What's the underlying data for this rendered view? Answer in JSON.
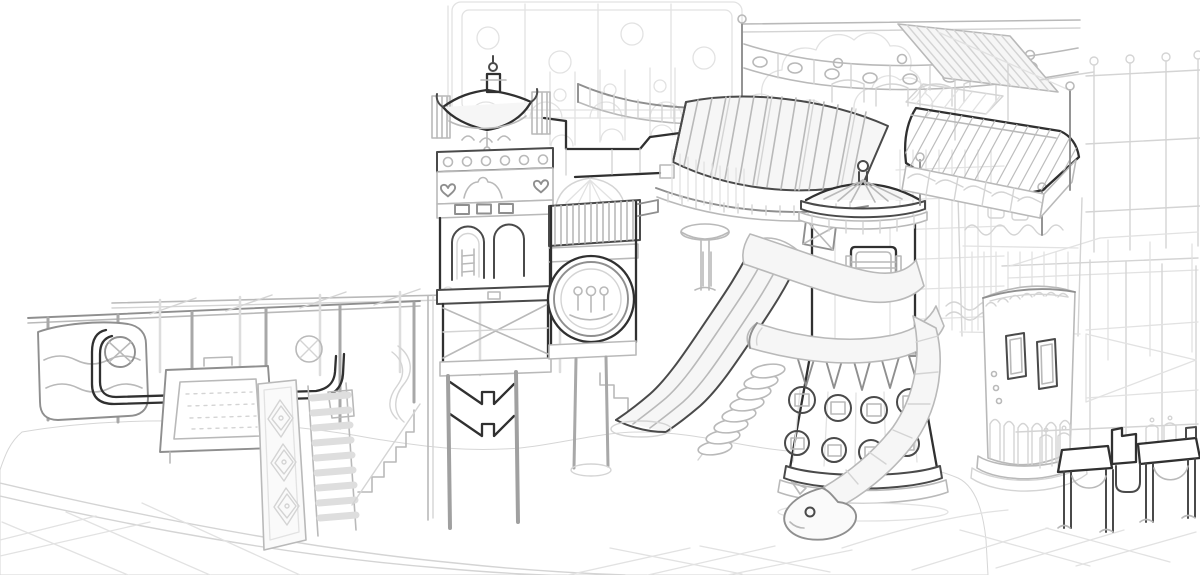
{
  "meta": {
    "title": "Indoor playground structure - concept line sketch",
    "medium": "grayscale pencil-style digital sketch",
    "canvas_width": 1200,
    "canvas_height": 575
  },
  "palette": {
    "background": "#ffffff",
    "line_faint": "#e2e2e2",
    "line_mid": "#b9b9b9",
    "line_dark": "#8f8f8f",
    "line_emphasis": "#303030",
    "shade_light": "#f6f6f6",
    "ball_line": "#c9c9c9"
  },
  "scene": {
    "description": "Hand-drawn isometric concept sketch of an indoor children's playground: towers with pagoda and dome roofs, wave and tube slides, climbing frames, striped awnings and a large ball pit on a tiled floor.",
    "elements": {
      "wall_panels": {
        "label": "Faint background wall panels with circles and arches"
      },
      "foliage": {
        "label": "Soft foliage cloud outlines"
      },
      "rail_bridge": {
        "label": "Elevated bridge railing with oval cutouts and striped roof"
      },
      "top_right_frame": {
        "label": "Tall open frame with ball finials"
      },
      "scaffold_frame": {
        "label": "Open scaffold frame with triangular platform"
      },
      "background_tower": {
        "label": "Background tower with scalloped band"
      },
      "walkway_bridge": {
        "label": "Curved raised walkway with stepped parapet"
      },
      "ball_pit": {
        "label": "Large ball pit filled with small balls"
      },
      "floor_tiles": {
        "label": "Tiled floor around the ball pit"
      },
      "left_play_frame": {
        "label": "Low play frame with posts, rails and curved panel"
      },
      "activity_panel": {
        "label": "Decorated activity panel on legs"
      },
      "toddler_climbers": {
        "label": "Diamond mat, rung climber and small stairs into the pit"
      },
      "pagoda_tower": {
        "label": "Pagoda-roof tower with arched windows and chevron base"
      },
      "spinner_wheel": {
        "label": "Round spinner wheel feature with slatted awning"
      },
      "striped_awning": {
        "label": "Large striped awning over a curved balcony"
      },
      "wave_slide": {
        "label": "Triple-lane wave slide into the ball pit"
      },
      "spiral_stairs": {
        "label": "Padded spiral steps"
      },
      "main_tower": {
        "label": "Round tower with striped dome, crest and porthole base"
      },
      "tube_slide": {
        "label": "Spiral tube slide wrapping the tower, ending in a creature head"
      },
      "padded_platform": {
        "label": "Hatched padded platform with wave railing"
      },
      "round_tower_right": {
        "label": "Round tower with rounded windows and arch skirt"
      },
      "bench_structure": {
        "label": "Bench structure with arched legs"
      }
    }
  }
}
